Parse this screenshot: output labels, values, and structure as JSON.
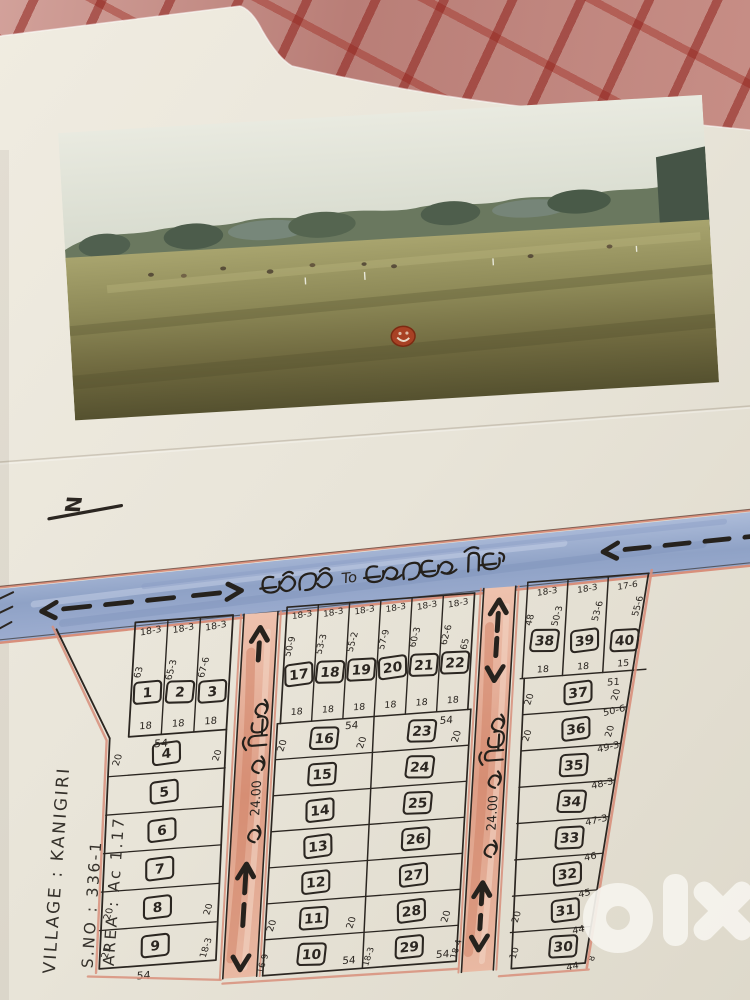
{
  "north_indicator": "N",
  "roads": {
    "main_road_label": "కనిగిరి To కలగట్ల రోడ్",
    "main_road_connector": "To",
    "cross_road_width": "24.00",
    "cross_road_label_left": "24.00 వ రోడ్డు",
    "cross_road_label_right": "24.00 వ రోడ్డు"
  },
  "village_info": {
    "village": "VILLAGE : KANIGIRI",
    "survey_no": "S.NO : 336-1",
    "area": "AREA : Ac 1.17"
  },
  "watermark": "olx",
  "plan": {
    "left_block": {
      "width_label": "54",
      "bottom_label": "54",
      "top_strips": [
        {
          "no": "1",
          "top": "18-3",
          "depth": "63",
          "bottom": "18"
        },
        {
          "no": "2",
          "top": "18-3",
          "depth": "65-3",
          "bottom": "18"
        },
        {
          "no": "3",
          "top": "18-3",
          "depth": "67-6",
          "bottom": "18"
        }
      ],
      "rows": [
        {
          "no": "4",
          "left": "20",
          "right": "20"
        },
        {
          "no": "5"
        },
        {
          "no": "6"
        },
        {
          "no": "7"
        },
        {
          "no": "8",
          "left": "20",
          "right": "20"
        },
        {
          "no": "9",
          "left": "21",
          "right": "18-3"
        }
      ]
    },
    "middle_block": {
      "right_edge_depth": "65",
      "top_strips": [
        {
          "no": "17",
          "top": "18-3",
          "depth": "50-9",
          "bottom": "18"
        },
        {
          "no": "18",
          "top": "18-3",
          "depth": "53-3",
          "bottom": "18"
        },
        {
          "no": "19",
          "top": "18-3",
          "depth": "55-2",
          "bottom": "18"
        },
        {
          "no": "20",
          "top": "18-3",
          "depth": "57-9",
          "bottom": "18"
        },
        {
          "no": "21",
          "top": "18-3",
          "depth": "60-3",
          "bottom": "18"
        },
        {
          "no": "22",
          "top": "18-3",
          "depth": "62-6",
          "bottom": "18"
        }
      ],
      "left_col": {
        "width_label": "54",
        "bottom_label": "54",
        "bottom_left": "16-9",
        "bottom_right": "18-3",
        "plots": [
          {
            "no": "16",
            "left": "20",
            "right": "20"
          },
          {
            "no": "15"
          },
          {
            "no": "14"
          },
          {
            "no": "13"
          },
          {
            "no": "12"
          },
          {
            "no": "11",
            "left": "20",
            "right": "20"
          },
          {
            "no": "10"
          }
        ]
      },
      "right_col": {
        "width_label": "54",
        "bottom_label": "54",
        "bottom_right": "18-4",
        "plots": [
          {
            "no": "23",
            "right": "20"
          },
          {
            "no": "24"
          },
          {
            "no": "25"
          },
          {
            "no": "26"
          },
          {
            "no": "27"
          },
          {
            "no": "28",
            "right": "20"
          },
          {
            "no": "29"
          }
        ]
      }
    },
    "right_block": {
      "top_length": "51",
      "top_strips": [
        {
          "no": "38",
          "top": "18-3",
          "left_depth": "48",
          "depth": "50-3",
          "bottom": "18"
        },
        {
          "no": "39",
          "top": "18-3",
          "depth": "53-6",
          "bottom": "18"
        },
        {
          "no": "40",
          "top": "17-6",
          "depth": "55-6",
          "bottom": "15"
        }
      ],
      "rows": [
        {
          "no": "37",
          "left": "20",
          "right": "20",
          "bottom_right": "50-6"
        },
        {
          "no": "36",
          "left": "20",
          "right": "20",
          "bottom_right": "49-3"
        },
        {
          "no": "35",
          "bottom_right": "48-3"
        },
        {
          "no": "34",
          "bottom_right": "47-3"
        },
        {
          "no": "33",
          "bottom_right": "46"
        },
        {
          "no": "32",
          "bottom_right": "45"
        },
        {
          "no": "31",
          "left": "20",
          "bottom_right": "44"
        },
        {
          "no": "30",
          "left": "10",
          "bottom_right": "44",
          "corner": "8"
        }
      ]
    }
  }
}
